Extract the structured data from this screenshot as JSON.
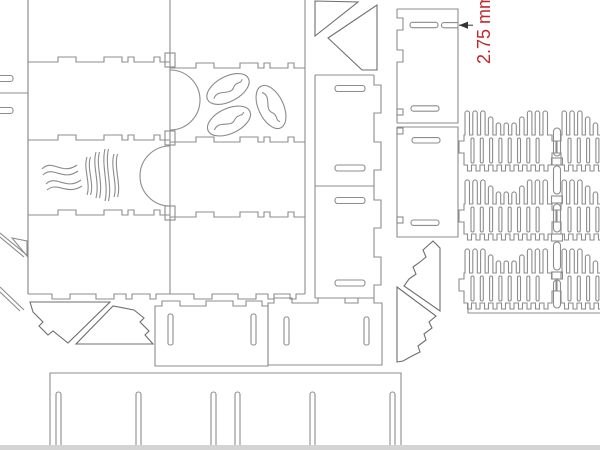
{
  "annotation": {
    "dimension_label": "2.75 mm"
  },
  "colors": {
    "background": "#ffffff",
    "cut-line": "#8c8c8c",
    "cut-line-dark": "#6e6e6e",
    "dimension-text": "#c4262b",
    "dimension-arrow": "#333333",
    "page-edge": "#d4d4d4"
  },
  "sheet": {
    "type": "laser-cut-template",
    "subject": "coffee crate cutting plan",
    "piece_names": [
      "side-panel-coffee-beans",
      "side-panel-steam",
      "plain-side-panels",
      "slotted-narrow-panels",
      "corner-triangle-gussets",
      "comb-rack-pieces",
      "base-panel-with-slots",
      "thickness-dimension-annotation"
    ]
  }
}
